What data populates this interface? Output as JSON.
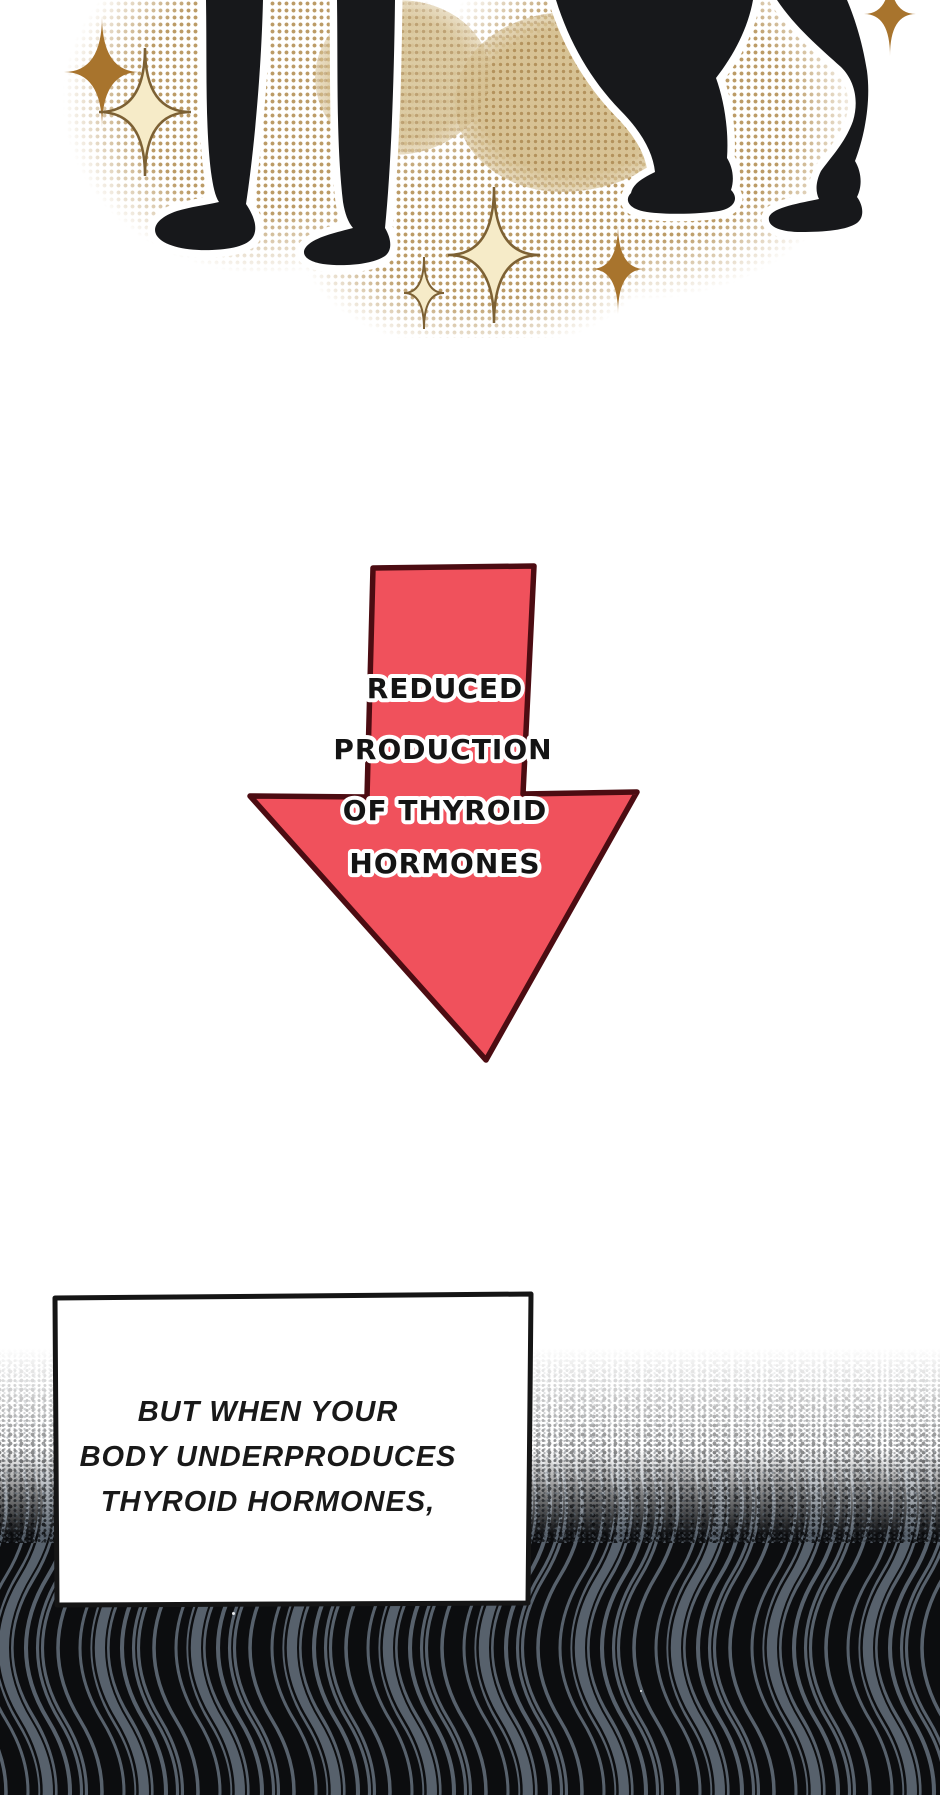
{
  "panel": {
    "kind": "webtoon comic panel",
    "arrow": {
      "lines": [
        "REDUCED",
        "PRODUCTION",
        "OF THYROID",
        "HORMONES"
      ]
    },
    "caption": {
      "lines": [
        "BUT WHEN YOUR",
        "BODY UNDERPRODUCES",
        "THYROID HORMONES,"
      ]
    }
  },
  "icons": {
    "sparkles": "four-point-sparkle-stars",
    "legs": "black-dog-leg-silhouettes"
  },
  "palette": {
    "arrow_fill": "#f0515c",
    "arrow_outline": "#4c0c12",
    "halftone_dot": "#bb9b66",
    "halftone_solid": "#d7c294",
    "star_gold": "#a8742d",
    "star_cream": "#f6ebc8",
    "star_cream_outline": "#7d6134",
    "legs_black": "#17181b",
    "wave_black": "#0c0d0f",
    "wave_slate": "#57616c",
    "box_border": "#151515",
    "text_black": "#191919"
  }
}
